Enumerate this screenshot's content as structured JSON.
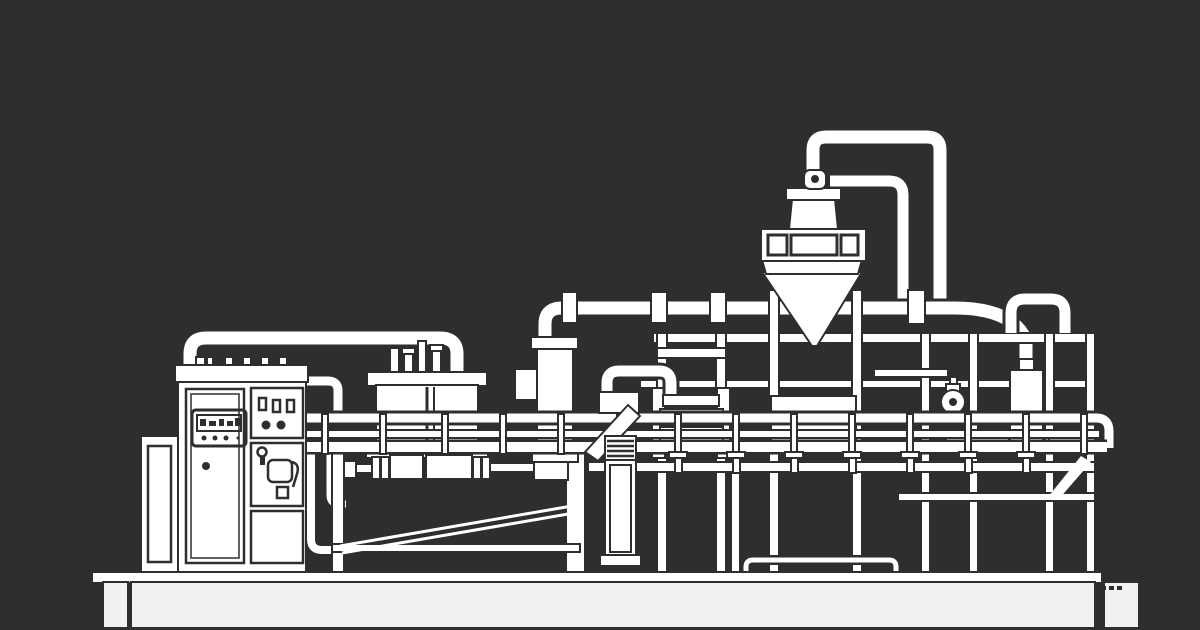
{
  "meta": {
    "description": "White line-art technical illustration of an industrial processing machine on a dark charcoal background",
    "style": "monochrome line drawing",
    "visible_text": "none"
  },
  "colors": {
    "background": "#2e2e2e",
    "line": "#ffffff",
    "panel_fill": "#f1f1f1"
  },
  "components": {
    "control_cabinet": "electrical control cabinet with display, toggle switches and buttons",
    "side_panel": "narrow auxiliary panel left of the cabinet",
    "feed_pipe_arch": "arched pipe from cabinet top to vessel lid",
    "mixing_vessel": "rectangular vessel with lid and top fittings",
    "vessel_stand": "legs, cross rail and diagonal brace under the vessel",
    "drive_shaft": "horizontal shaft with flanged couplings and cylinders",
    "filter_column": "vertical cylinder with side box and base flange",
    "support_pillar": "wide vertical support under the column",
    "blower_unit": "blower box with diagonal chute and finned stack",
    "process_hopper": "cone-bottom hopper with segmented ring, neck box and lid",
    "overhead_piping": "elbowed overhead pipes connecting hopper, column and canister",
    "frame_structure": "right-hand open frame with posts, rails and braces",
    "roller_assembly": "twin-drum roller unit between frame posts",
    "drum_unit": "wide banded drum on the frame",
    "valve_assembly": "round valve on a short pipe",
    "receiver_canister": "small hanging canister fed from curved pipe",
    "pipe_arch_right": "inverted-U pipe standing on the frame top",
    "safety_railing": "full-width double-rail guard railing with posts",
    "base_platform": "long white base slab with end blocks"
  }
}
